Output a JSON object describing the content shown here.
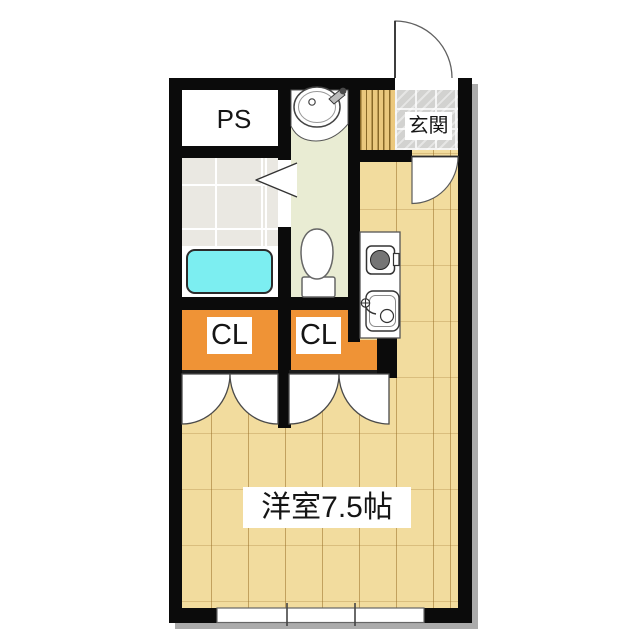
{
  "plan": {
    "type": "floor-plan",
    "rooms": {
      "ps": {
        "label": "PS"
      },
      "genkan": {
        "label": "玄関"
      },
      "closet1": {
        "label": "CL"
      },
      "closet2": {
        "label": "CL"
      },
      "main_room": {
        "label": "洋室7.5帖"
      }
    },
    "fixtures": [
      "bathtub",
      "toilet",
      "washbasin",
      "stove-burner",
      "kitchen-sink",
      "entrance-door",
      "hall-door",
      "bathroom-folding-door",
      "closet-double-doors",
      "closet-double-doors",
      "window",
      "shoe-cabinet"
    ],
    "colors": {
      "wall": "#0b0b0b",
      "wood_floor": "#f2dc9e",
      "washroom_floor": "#e9ecd3",
      "bath_tile": "#eae8e2",
      "genkan_tile": "#d2d2d0",
      "shoe_cabinet": "#ebc87d",
      "closet_orange": "#ef9336",
      "bathtub_cyan": "#7ceef1"
    }
  }
}
